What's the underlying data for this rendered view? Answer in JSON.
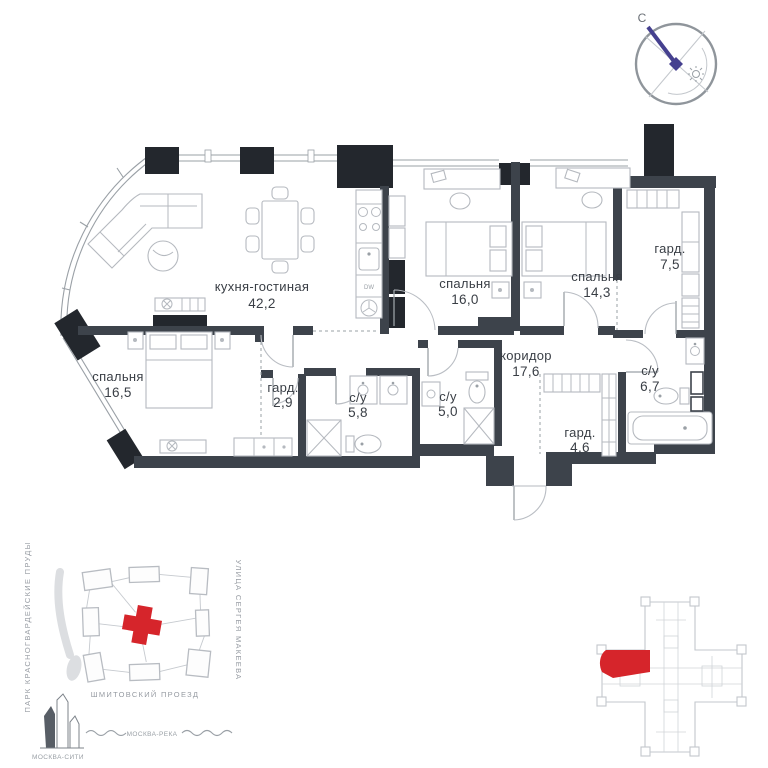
{
  "compass": {
    "north_label": "С"
  },
  "rooms": [
    {
      "key": "kitchen-living",
      "name": "кухня-гостиная",
      "area": "42,2"
    },
    {
      "key": "bedroom-1",
      "name": "спальня",
      "area": "16,0"
    },
    {
      "key": "bedroom-2",
      "name": "спальня",
      "area": "14,3"
    },
    {
      "key": "wardrobe-1",
      "name": "гард.",
      "area": "7,5"
    },
    {
      "key": "bedroom-3",
      "name": "спальня",
      "area": "16,5"
    },
    {
      "key": "wardrobe-2",
      "name": "гард.",
      "area": "2,9"
    },
    {
      "key": "bathroom-1",
      "name": "с/у",
      "area": "5,8"
    },
    {
      "key": "bathroom-2",
      "name": "с/у",
      "area": "5,0"
    },
    {
      "key": "corridor",
      "name": "коридор",
      "area": "17,6"
    },
    {
      "key": "wardrobe-3",
      "name": "гард.",
      "area": "4,6"
    },
    {
      "key": "bathroom-3",
      "name": "с/у",
      "area": "6,7"
    }
  ],
  "appliances": {
    "dishwasher": "DW"
  },
  "site_map": {
    "park_label": "ПАРК КРАСНОГВАРДЕЙСКИЕ ПРУДЫ",
    "street_right_label": "УЛИЦА СЕРГЕЯ МАКЕЕВА",
    "street_bottom_label": "ШМИТОВСКИЙ ПРОЕЗД",
    "city_label": "МОСКВА-СИТИ",
    "river_label": "МОСКВА-РЕКА"
  },
  "colors": {
    "wall": "#3d434b",
    "pylon": "#23272d",
    "accent_red": "#d6252b",
    "compass_needle": "#45408f",
    "line_gray": "#9aa0a6"
  }
}
